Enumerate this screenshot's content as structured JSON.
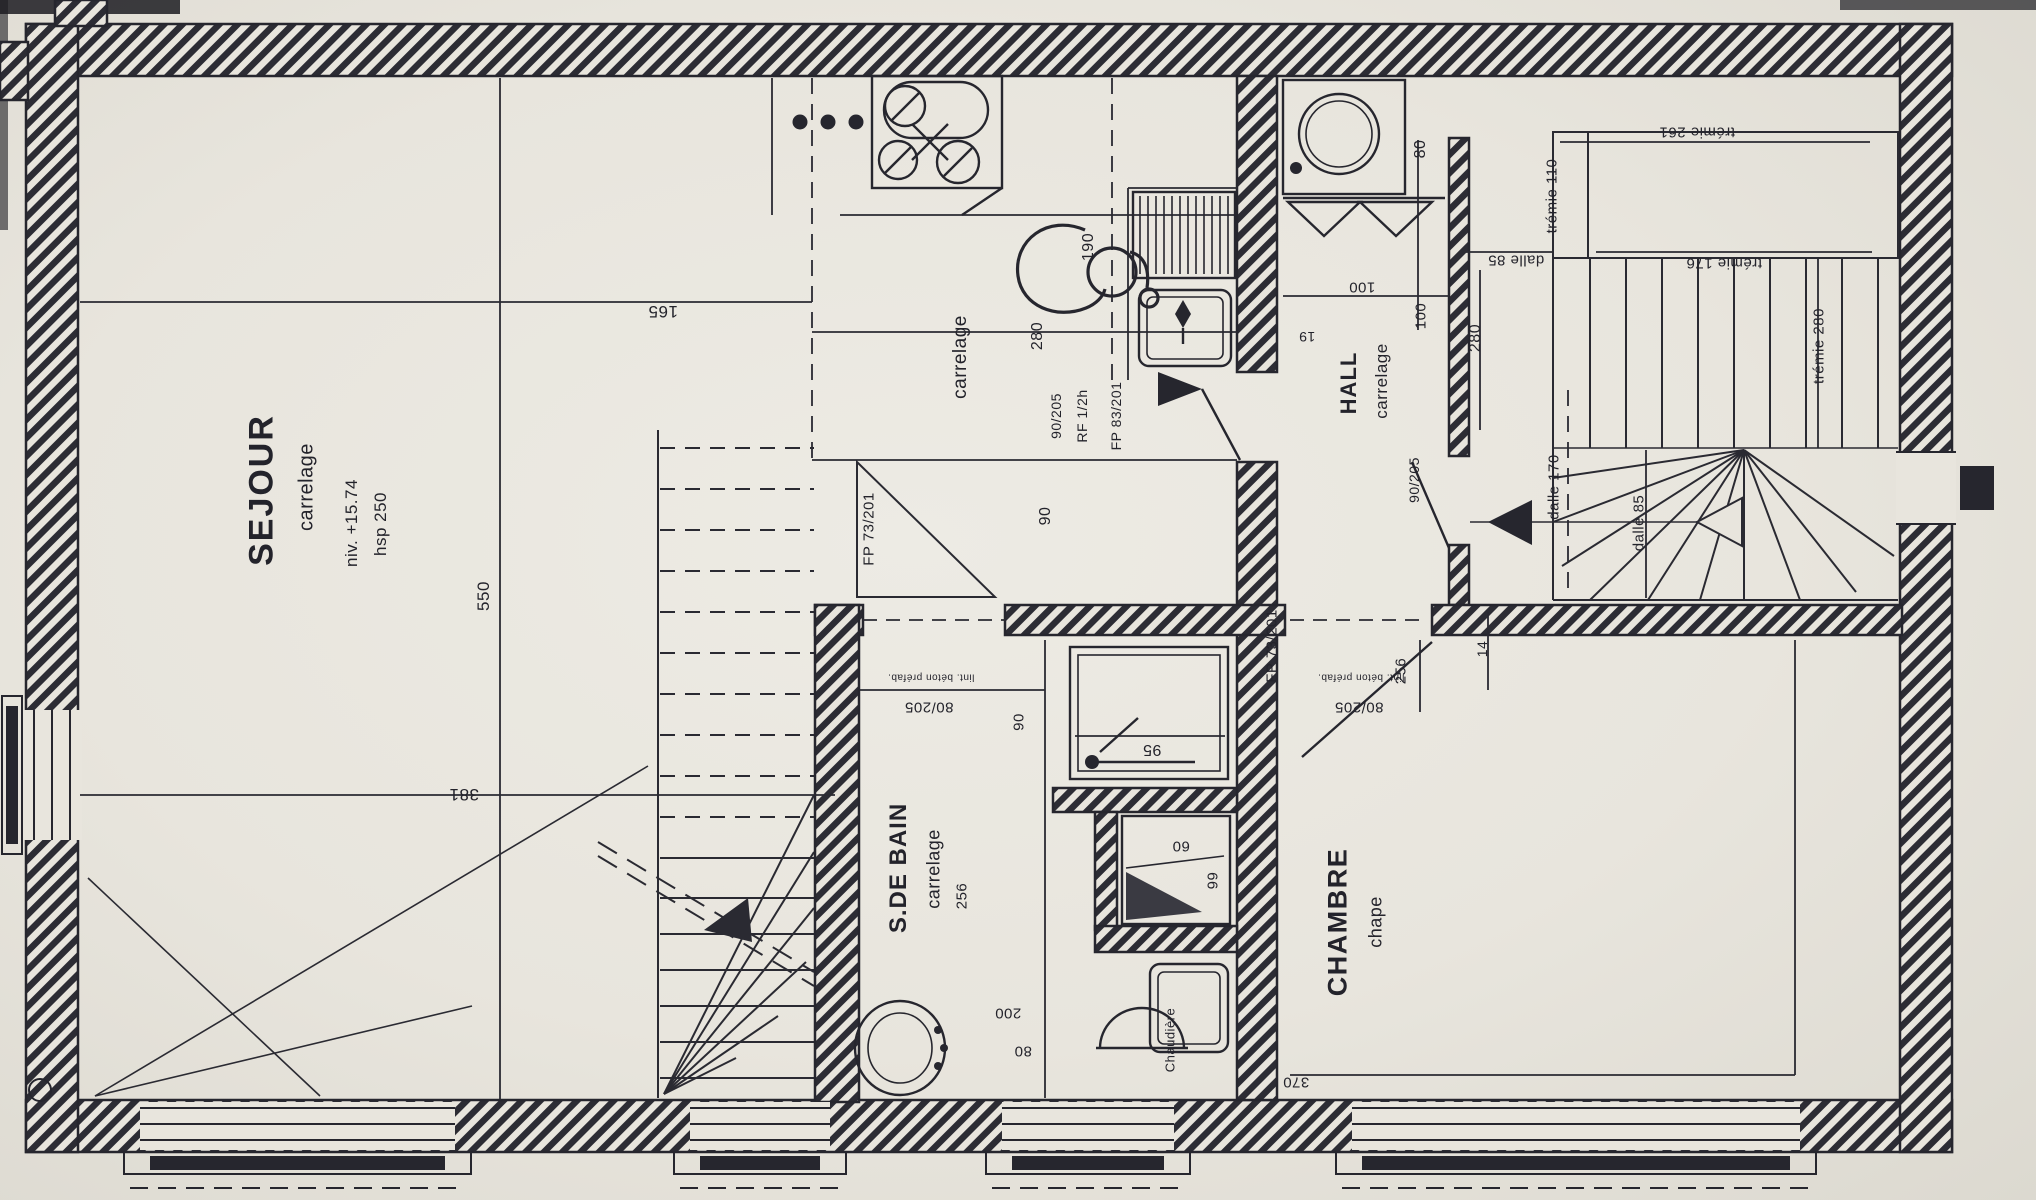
{
  "colors": {
    "paper": "#e8e5dd",
    "ink": "#26262e",
    "hatch": "#2c2c34"
  },
  "rooms": {
    "sejour": {
      "name": "SEJOUR",
      "floor": "carrelage",
      "level": "niv. +15.74",
      "ceiling": "hsp 250"
    },
    "kitchen": {
      "floor": "carrelage"
    },
    "hall": {
      "name": "HALL",
      "floor": "carrelage"
    },
    "bathroom": {
      "name": "S.DE BAIN",
      "floor": "carrelage"
    },
    "bedroom": {
      "name": "CHAMBRE",
      "floor": "chape"
    }
  },
  "fixtures": {
    "boiler": "Chaudière"
  },
  "doors": {
    "fp73_stairs": "FP 73/201",
    "fp73_bedroom": "FP 73/201",
    "fp83_hall": "FP 83/201",
    "size_90205_hall": "90/205",
    "fire_rating": "RF 1/2h",
    "size_90205_stairs": "90/205",
    "size_80205_bath": "80/205",
    "size_80205_bedroom": "80/205",
    "lintel_bath": "lint. béton préfab.",
    "lintel_bedroom": "lint. béton préfab."
  },
  "slab_openings": {
    "tremie_110": "trémie 110",
    "tremie_261": "trémie 261",
    "tremie_176": "trémie 176",
    "tremie_280": "trémie 280",
    "dalle_85_top": "dalle 85",
    "dalle_85_stairs": "dalle 85",
    "dalle_170": "dalle 170"
  },
  "dimensions": {
    "sejour_width": "165",
    "sejour_depth": "550",
    "sejour_left": "381",
    "kitchen_depth": "280",
    "kitchen_sink": "190",
    "kitchen_low": "90",
    "machine": "80",
    "hall_a": "100",
    "hall_b": "100",
    "hall_c": "19",
    "stairs_width": "280",
    "bedroom_door_side": "14",
    "bath_length": "256",
    "bath_door": "90",
    "bath_low": "200",
    "bath_wc": "80",
    "tub": "95",
    "shower_a": "60",
    "shower_b": "66",
    "bedroom_width": "256",
    "bedroom_length": "370"
  }
}
